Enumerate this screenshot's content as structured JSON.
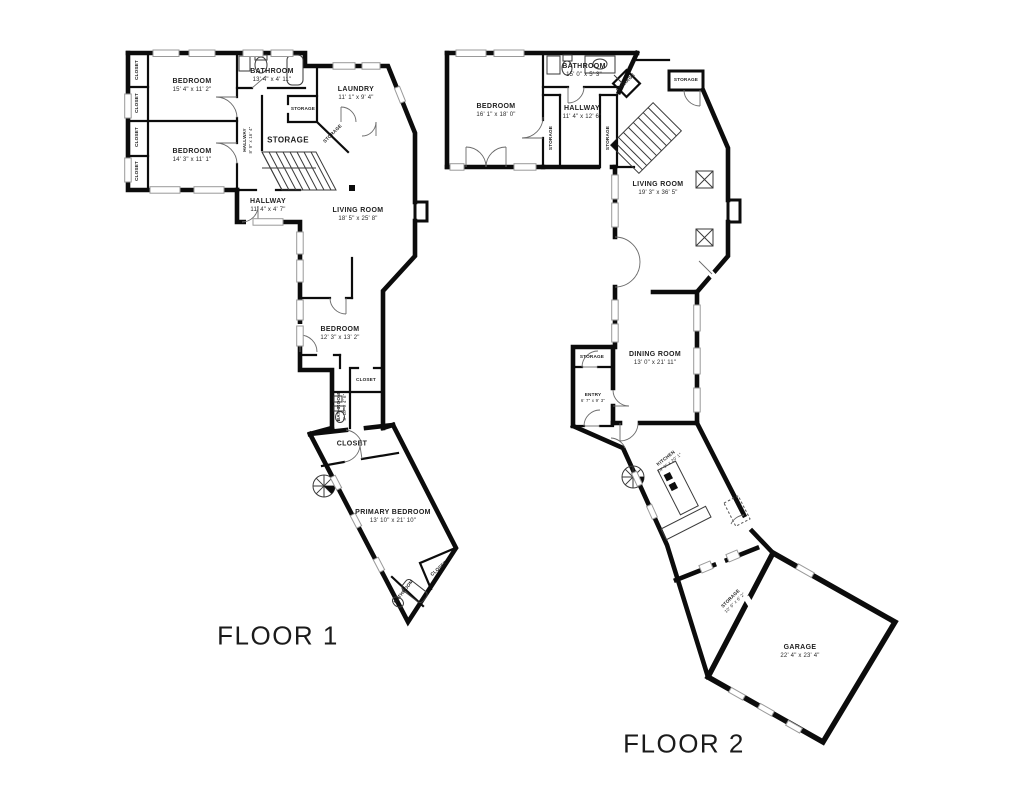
{
  "floor1": {
    "caption": "FLOOR 1",
    "closets_left": [
      "CLOSET",
      "CLOSET",
      "CLOSET",
      "CLOSET"
    ],
    "bedroom1": {
      "name": "BEDROOM",
      "dims": "15' 4\" x 11' 2\""
    },
    "bedroom2": {
      "name": "BEDROOM",
      "dims": "14' 3\" x 11' 1\""
    },
    "bathroom_top": {
      "name": "BATHROOM",
      "dims": "13' 4\" x 4' 11\""
    },
    "laundry": {
      "name": "LAUNDRY",
      "dims": "11' 1\" x 9' 4\""
    },
    "hallway_vertical": {
      "name": "HALLWAY",
      "dims": "8' 9\" x 16' 4\""
    },
    "storage_room": {
      "name": "STORAGE"
    },
    "storage_small": {
      "name": "STORAGE"
    },
    "storage_angled": {
      "name": "STORAGE"
    },
    "hallway_lower": {
      "name": "HALLWAY",
      "dims": "11' 4\" x 4' 7\""
    },
    "living_room": {
      "name": "LIVING ROOM",
      "dims": "18' 5\" x 25' 8\""
    },
    "bedroom3": {
      "name": "BEDROOM",
      "dims": "12' 3\" x 13' 2\""
    },
    "closet_hall": {
      "name": "CLOSET"
    },
    "bathroom_mid": {
      "name": "BATHROOM",
      "dims": "8' 10\" x 4' 6\""
    },
    "closet_primary": {
      "name": "CLOSET"
    },
    "primary_bedroom": {
      "name": "PRIMARY BEDROOM",
      "dims": "13' 10\" x 21' 10\""
    },
    "closet_corner": {
      "name": "CLOSET"
    },
    "bathroom_primary": {
      "name": "BATHROOM"
    }
  },
  "floor2": {
    "caption": "FLOOR 2",
    "bedroom": {
      "name": "BEDROOM",
      "dims": "16' 1\" x 18' 0\""
    },
    "bathroom": {
      "name": "BATHROOM",
      "dims": "15' 0\" x 5' 3\""
    },
    "storage_corner": {
      "name": "STORAGE"
    },
    "storage_top": {
      "name": "STORAGE"
    },
    "hallway": {
      "name": "HALLWAY",
      "dims": "11' 4\" x 12' 6\""
    },
    "storage_left": {
      "name": "STORAGE"
    },
    "storage_right": {
      "name": "STORAGE"
    },
    "living_room": {
      "name": "LIVING ROOM",
      "dims": "19' 3\" x 36' 5\""
    },
    "storage_entry": {
      "name": "STORAGE"
    },
    "dining_room": {
      "name": "DINING ROOM",
      "dims": "13' 0\" x 21' 11\""
    },
    "entry": {
      "name": "ENTRY",
      "dims": "6' 7\" x 9' 3\""
    },
    "kitchen": {
      "name": "KITCHEN",
      "dims": "14' 9\" x 20' 1\""
    },
    "storage_garage": {
      "name": "STORAGE",
      "dims": "10' 9\" x 6' 2\""
    },
    "garage": {
      "name": "GARAGE",
      "dims": "22' 4\" x 23' 4\""
    }
  }
}
